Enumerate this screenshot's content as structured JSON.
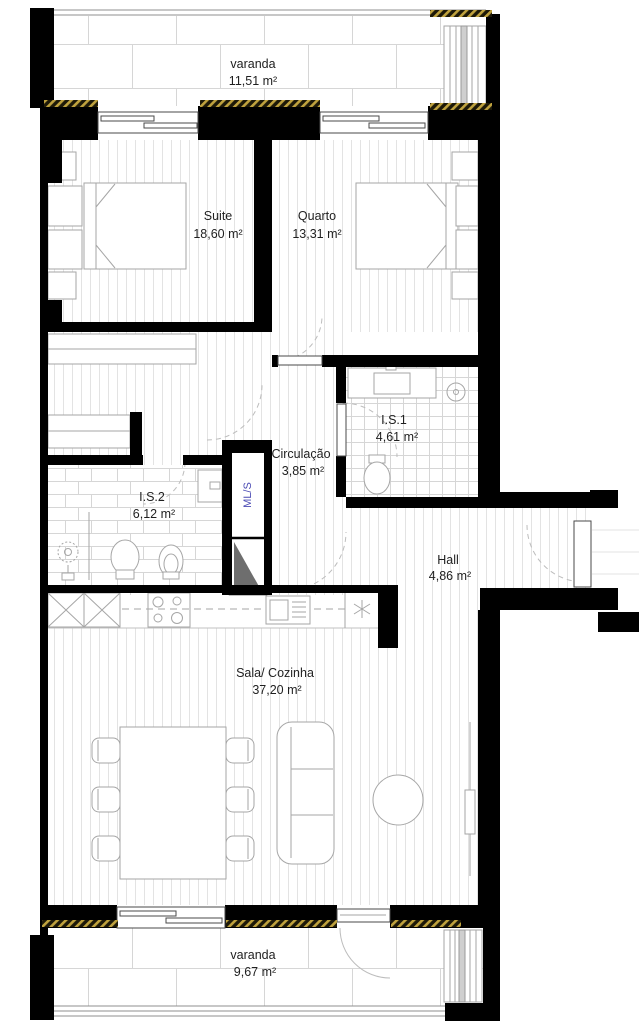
{
  "plan": {
    "type": "apartment floor plan",
    "language": "pt"
  },
  "rooms": [
    {
      "id": "varanda-norte",
      "name": "varanda",
      "area": "11,51 m²"
    },
    {
      "id": "suite",
      "name": "Suite",
      "area": "18,60 m²"
    },
    {
      "id": "quarto",
      "name": "Quarto",
      "area": "13,31 m²"
    },
    {
      "id": "is1",
      "name": "I.S.1",
      "area": "4,61 m²"
    },
    {
      "id": "circulacao",
      "name": "Circulação",
      "area": "3,85 m²"
    },
    {
      "id": "is2",
      "name": "I.S.2",
      "area": "6,12 m²"
    },
    {
      "id": "hall",
      "name": "Hall",
      "area": "4,86 m²"
    },
    {
      "id": "sala-cozinha",
      "name": "Sala/ Cozinha",
      "area": "37,20 m²"
    },
    {
      "id": "varanda-sul",
      "name": "varanda",
      "area": "9,67 m²"
    }
  ],
  "annotations": {
    "laundry_label": "ML/S"
  },
  "colors": {
    "wall": "#000000",
    "floor_line": "#e3e3e3",
    "tile_line": "#d6d6d6",
    "furniture_line": "#a6a6a6",
    "text": "#1f1f1f",
    "laundry_text": "#4a4ab4",
    "insulation_hatch": "#bfa23e",
    "shaft_fill": "#6e6e6e",
    "door_arc": "#bdbdbd"
  }
}
